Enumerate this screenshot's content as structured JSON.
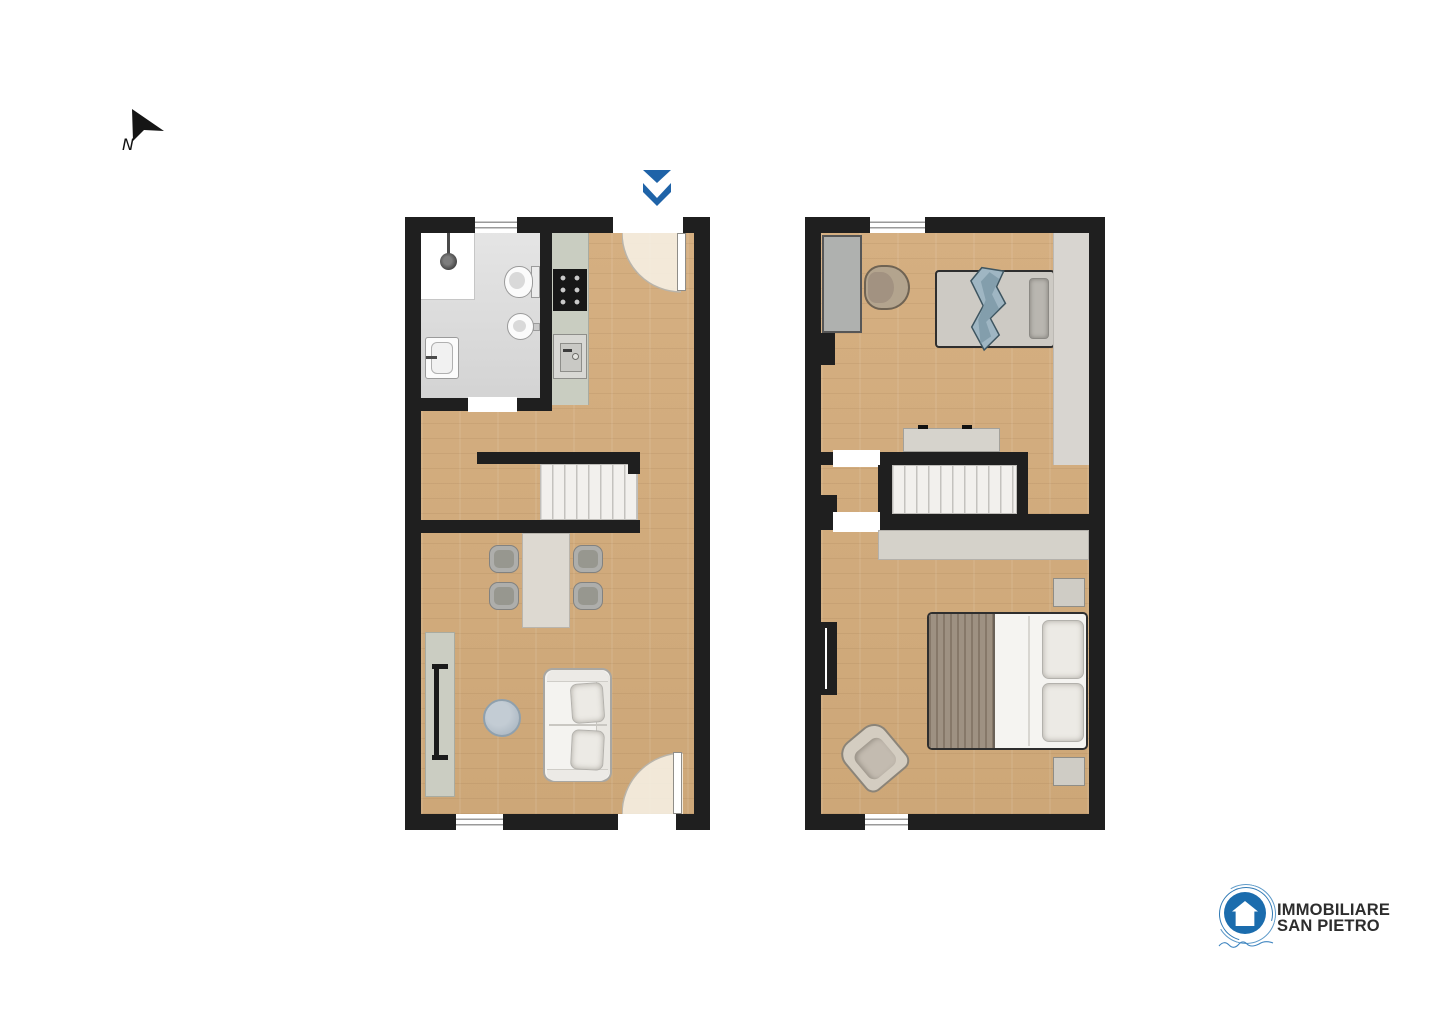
{
  "north_indicator": {
    "label": "N"
  },
  "entrance_marker": {
    "shape": "double-chevron-down",
    "color": "#1f63a8"
  },
  "palette": {
    "wall": "#1f1f1f",
    "wood_floor": "#d2ac7e",
    "bathroom_tile": "#dcdcdc",
    "kitchen_counter": "#c9cdc1",
    "stairs": "#f2f0ed",
    "door_swing": "#f8f3e9",
    "accent_blue": "#1f63a8",
    "logo_blue": "#1b6cad",
    "blanket_blue": "#9fb6c3",
    "bed_blanket_taupe": "#9e9182"
  },
  "floor_plans": [
    {
      "id": "ground-floor",
      "rooms": [
        "bathroom",
        "kitchen",
        "hallway",
        "dining-living-room"
      ],
      "furniture": [
        "shower",
        "toilet",
        "bidet",
        "washbasin",
        "cooktop",
        "kitchen-sink",
        "staircase",
        "dining-table",
        "chair",
        "chair",
        "chair",
        "chair",
        "sideboard",
        "radiator",
        "round-pouf",
        "sofa"
      ],
      "openings": [
        "top-window",
        "entrance-door-with-swing",
        "bathroom-door",
        "bottom-window",
        "garden-door-with-swing"
      ]
    },
    {
      "id": "first-floor",
      "rooms": [
        "bedroom-1",
        "stair-landing",
        "bedroom-2"
      ],
      "furniture": [
        "wardrobe",
        "armchair",
        "single-bed",
        "dresser",
        "staircase",
        "built-in-closet",
        "nightstand",
        "double-bed",
        "nightstand",
        "armchair"
      ],
      "openings": [
        "top-window",
        "bedroom-1-door",
        "bedroom-2-door",
        "bottom-window",
        "wall-niche"
      ]
    }
  ],
  "logo": {
    "line1": "IMMOBILIARE",
    "line2": "SAN PIETRO",
    "text_color": "#2d2d2d",
    "emblem": "house-in-circle",
    "emblem_color": "#1b6cad"
  }
}
